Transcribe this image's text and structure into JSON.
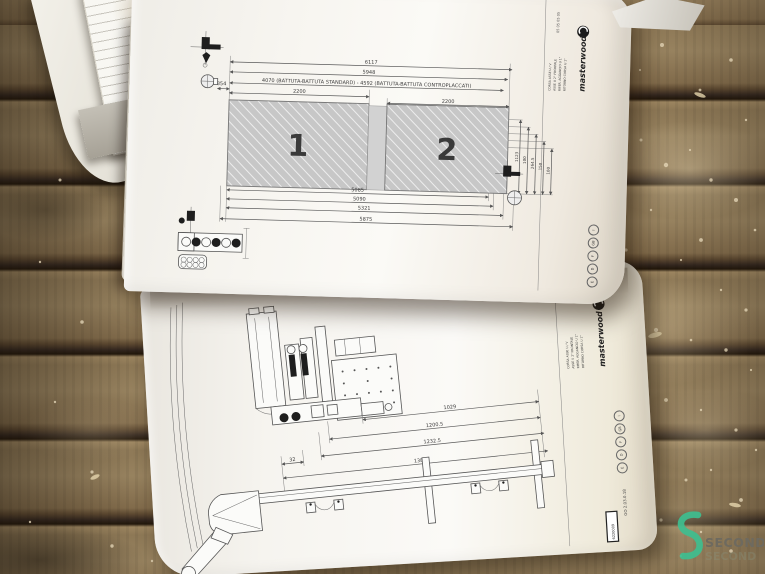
{
  "scene": {
    "description": "photo of open technical-drawing booklet on grooved wooden workbench with sawdust",
    "accent_colors": {
      "watermark_green": "#3EBE8F",
      "wood_brown": "#7a644a",
      "hatch_gray": "#c7c7c7"
    }
  },
  "icons": {
    "spindle-tool-icon": "cross-shaped boring spindle symbol",
    "origin-circle-icon": "circle with crosshair",
    "boring-head-icon": "row of drill circles",
    "brand-mark-icon": "masterwood circle swirl",
    "watermark-s-icon": "green ribbon S"
  },
  "top_page": {
    "panel_labels": [
      "1",
      "2"
    ],
    "dims_top": [
      "6117",
      "5948",
      "4070 (BATTUTA-BATTUTA STANDARD) - 4592 (BATTUTA-BATTUTA CONTROPLACCATI)",
      "2200",
      "2200"
    ],
    "dim_left": "354",
    "dims_bottom": [
      "5085",
      "5090",
      "5321",
      "5875"
    ],
    "dims_right": [
      "1123",
      "100",
      "264.5",
      "150",
      "100"
    ],
    "corner_codes": "05 05 05 05",
    "title_block": {
      "brand": "masterwood",
      "lines": [
        "CORSA ASSE U / V",
        "ASSE U 2° FRONTALE",
        "RIFER. AGGANCIO U 1°",
        "RITORNO CORSA U 1°"
      ]
    },
    "edge_marks": [
      "I",
      "GB",
      "F",
      "D",
      "E"
    ]
  },
  "bottom_page": {
    "dims": [
      "1029",
      "1200.5",
      "1232.5",
      "1380"
    ],
    "dim_small": "32",
    "title_block": {
      "brand": "masterwood",
      "lines": [
        "CORSA ASSE U / V",
        "ASSE U 2° FRONTALE",
        "RIFER. AGGANCIO U 1°",
        "RITORNO CORSA U 1°"
      ]
    },
    "edge_marks": [
      "I",
      "GB",
      "F",
      "D",
      "E"
    ],
    "doc_code": "GO 2.03.0.18",
    "part_code": "6220009"
  },
  "watermark": {
    "brand": "SECOND",
    "shadow_text": "SECOND"
  }
}
